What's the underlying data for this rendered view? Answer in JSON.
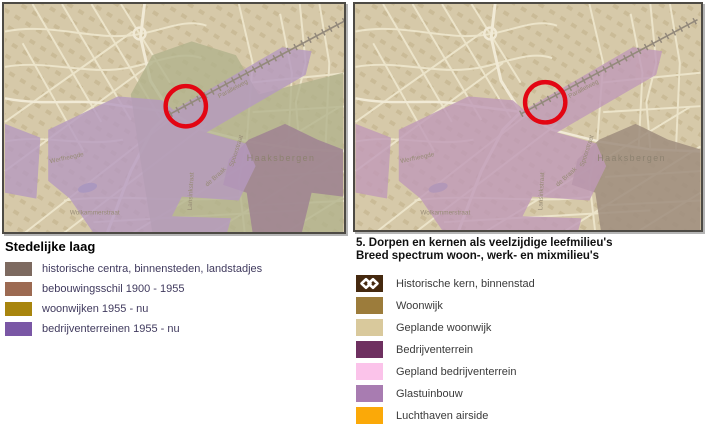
{
  "left_legend": {
    "title": "Stedelijke laag",
    "items": [
      {
        "label": "historische centra, binnensteden, landstadjes",
        "color": "#7d6a60"
      },
      {
        "label": "bebouwingsschil 1900 - 1955",
        "color": "#9c6a52"
      },
      {
        "label": "woonwijken 1955 - nu",
        "color": "#a8850e"
      },
      {
        "label": "bedrijventerreinen 1955 - nu",
        "color": "#7a57a5"
      }
    ]
  },
  "right_legend": {
    "title_line1": "5. Dorpen en kernen als veelzijdige leefmilieu's",
    "title_line2": "Breed spectrum woon-, werk- en mixmilieu's",
    "items": [
      {
        "label": "Historische kern, binnenstad",
        "color": "#45290f",
        "pattern": "chain-links"
      },
      {
        "label": "Woonwijk",
        "color": "#9c7c3b"
      },
      {
        "label": "Geplande woonwijk",
        "color": "#d9c99c"
      },
      {
        "label": "Bedrijventerrein",
        "color": "#6e3060"
      },
      {
        "label": "Gepland bedrijventerrein",
        "color": "#fbc3ea"
      },
      {
        "label": "Glastuinbouw",
        "color": "#a87cb1"
      },
      {
        "label": "Luchthaven airside",
        "color": "#fba908"
      }
    ]
  },
  "map_labels": {
    "town": "Haaksbergen",
    "street_parallelweg": "Parallelweg",
    "street_werfheegde": "Werfheegde",
    "street_spoorstraat": "Spoorstraat",
    "street_de_braak": "de Braak",
    "street_wolkammerstraat": "Wolkammerstraat",
    "street_lansinkstraat": "Lansinkstraat"
  },
  "annotation": {
    "red_circle_color": "#e30613"
  }
}
